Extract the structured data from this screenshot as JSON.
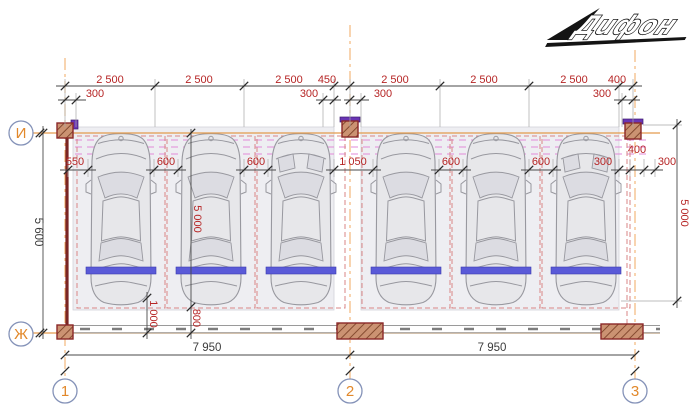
{
  "logo": {
    "text": "Дифон"
  },
  "axes": {
    "left": [
      "И",
      "Ж"
    ],
    "bottom": [
      "1",
      "2",
      "3"
    ]
  },
  "dims": {
    "top": [
      "2 500",
      "2 500",
      "2 500",
      "450",
      "2 500",
      "2 500",
      "2 500",
      "400"
    ],
    "offsets": [
      "300",
      "300",
      "300",
      "300"
    ],
    "mid": [
      "550",
      "600",
      "600",
      "1 050",
      "600",
      "600",
      "300",
      "400",
      "300"
    ],
    "depth_total": "5 600",
    "stall_depth_left": "5 000",
    "stall_depth_right": "5 000",
    "rear_gap": "1 000",
    "rear_offset": "800",
    "bottom": [
      "7 950",
      "7 950"
    ]
  },
  "colors": {
    "dim_text_red": "#b62525",
    "dim_text_dark": "#3c3c3c",
    "axis_label_orange": "#e2882a",
    "axis_circle_stroke": "#8492b8",
    "centerline_orange": "#f0aa60",
    "axis_line_orange": "#e39a4d",
    "parking_line_pink": "#e18ad8",
    "stall_dash_red": "#d98585",
    "bay_fill": "#eeeef2",
    "car_fill": "#e7e7ea",
    "car_line": "#98989f",
    "glass_fill": "#dcdce2",
    "wheel_stop_blue": "#5a5ad8",
    "column_fill": "#cb9272",
    "column_hatch": "#7c4228",
    "column_edge": "#8a2828",
    "wall_red": "#7a2525",
    "bottom_wall_gray": "#9a9a9a",
    "dim_line_gray": "#4a4a4a",
    "purple_cap": "#6a35b5",
    "logo_black": "#141414"
  }
}
